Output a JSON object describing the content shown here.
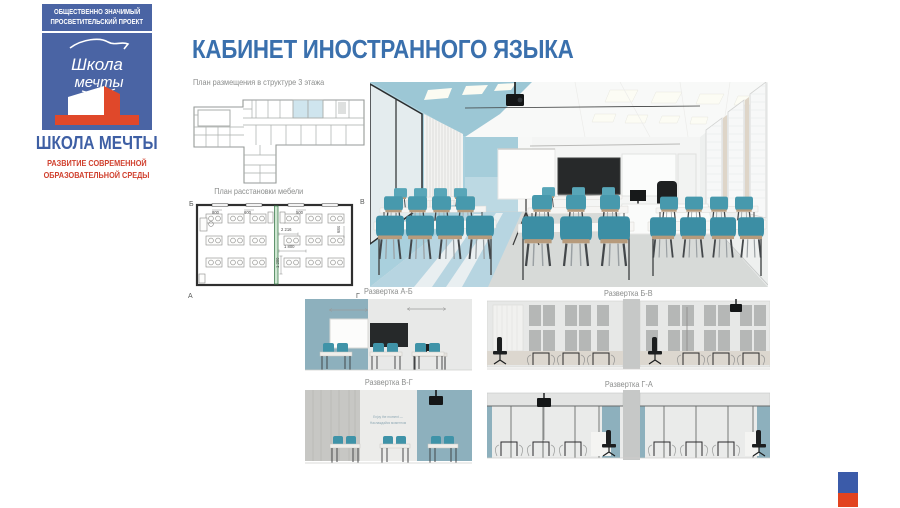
{
  "slide": {
    "title": "КАБИНЕТ ИНОСТРАННОГО ЯЗЫКА"
  },
  "logo": {
    "banner_line1": "ОБЩЕСТВЕННО ЗНАЧИМЫЙ",
    "banner_line2": "ПРОСВЕТИТЕЛЬСКИЙ ПРОЕКТ",
    "script_line1": "Школа",
    "script_line2": "мечты",
    "name": "ШКОЛА МЕЧТЫ",
    "tagline_line1": "РАЗВИТИЕ СОВРЕМЕННОЙ",
    "tagline_line2": "ОБРАЗОВАТЕЛЬНОЙ СРЕДЫ"
  },
  "plans": {
    "structure_caption": "План размещения в структуре 3 этажа",
    "furniture_caption": "План расстановки мебели",
    "corners": {
      "tl": "Б",
      "tr": "В",
      "bl": "А",
      "br": "Г"
    },
    "dims": {
      "d1": "2 216",
      "d2": "1 800",
      "d3": "1 200",
      "d4": "800",
      "d5": "600",
      "d6": "500",
      "d7": "684"
    }
  },
  "elevations": {
    "ab_caption": "Развертка А-Б",
    "bv_caption": "Развертка Б-В",
    "vg_caption": "Развертка В-Г",
    "ga_caption": "Развертка Г-А",
    "wall_quote_line1": "Enjoy the moment —",
    "wall_quote_line2": "Наслаждайся моментом"
  },
  "colors": {
    "title_blue": "#3a70ad",
    "logo_blue": "#4a64a4",
    "logo_red": "#da472e",
    "caption_gray": "#8b8d8c",
    "plan_highlight": "#cfe5ee",
    "teal_wall": "#8db0bd",
    "chair_teal": "#3c8ea4"
  }
}
